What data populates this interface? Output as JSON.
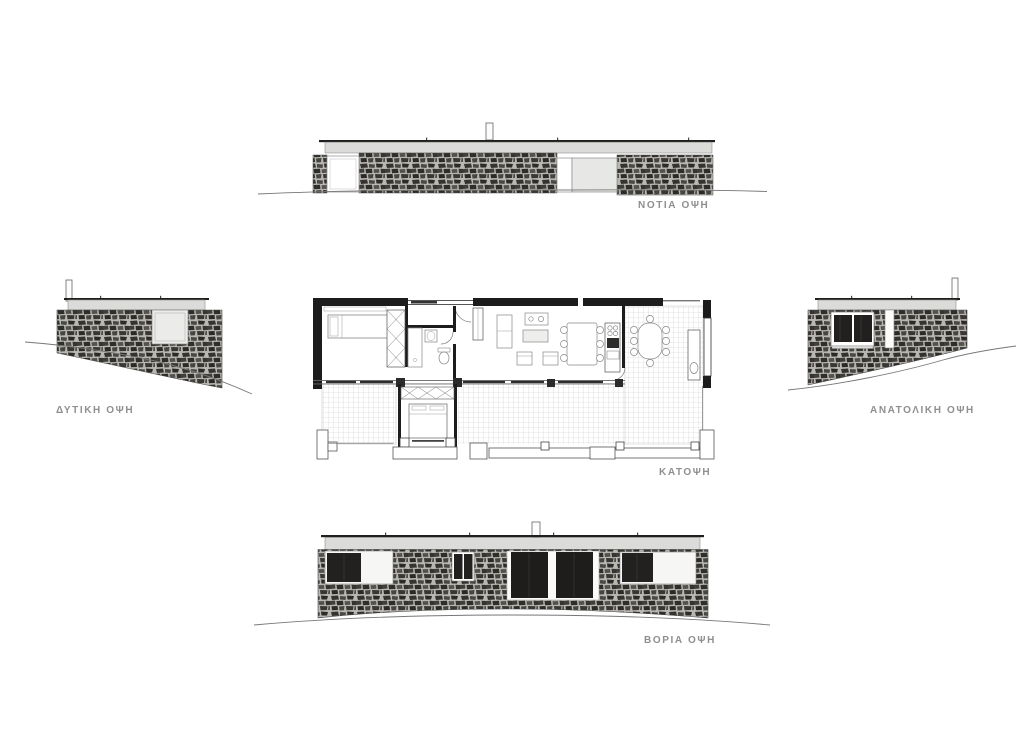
{
  "labels": {
    "south_elevation": "ΝΟΤΙΑ ΟΨΗ",
    "west_elevation": "ΔΥΤΙΚΗ ΟΨΗ",
    "east_elevation": "ΑΝΑΤΟΛΙΚΗ ΟΨΗ",
    "floor_plan": "ΚΑΤΟΨΗ",
    "north_elevation": "ΒΟΡΙΑ ΟΨΗ"
  },
  "colors": {
    "paper": "#ffffff",
    "label_text": "#8f8f8f",
    "stone_mortar": "#b9b7b2",
    "stone_dark": "#2e2d2a",
    "fascia_band": "#dbdbd9",
    "roof_line": "#1f1f1d",
    "glass_dark": "#22211f",
    "ground_line": "#777777",
    "tile_grid": "#cfcecb",
    "plan_wall": "#1c1c1c"
  }
}
